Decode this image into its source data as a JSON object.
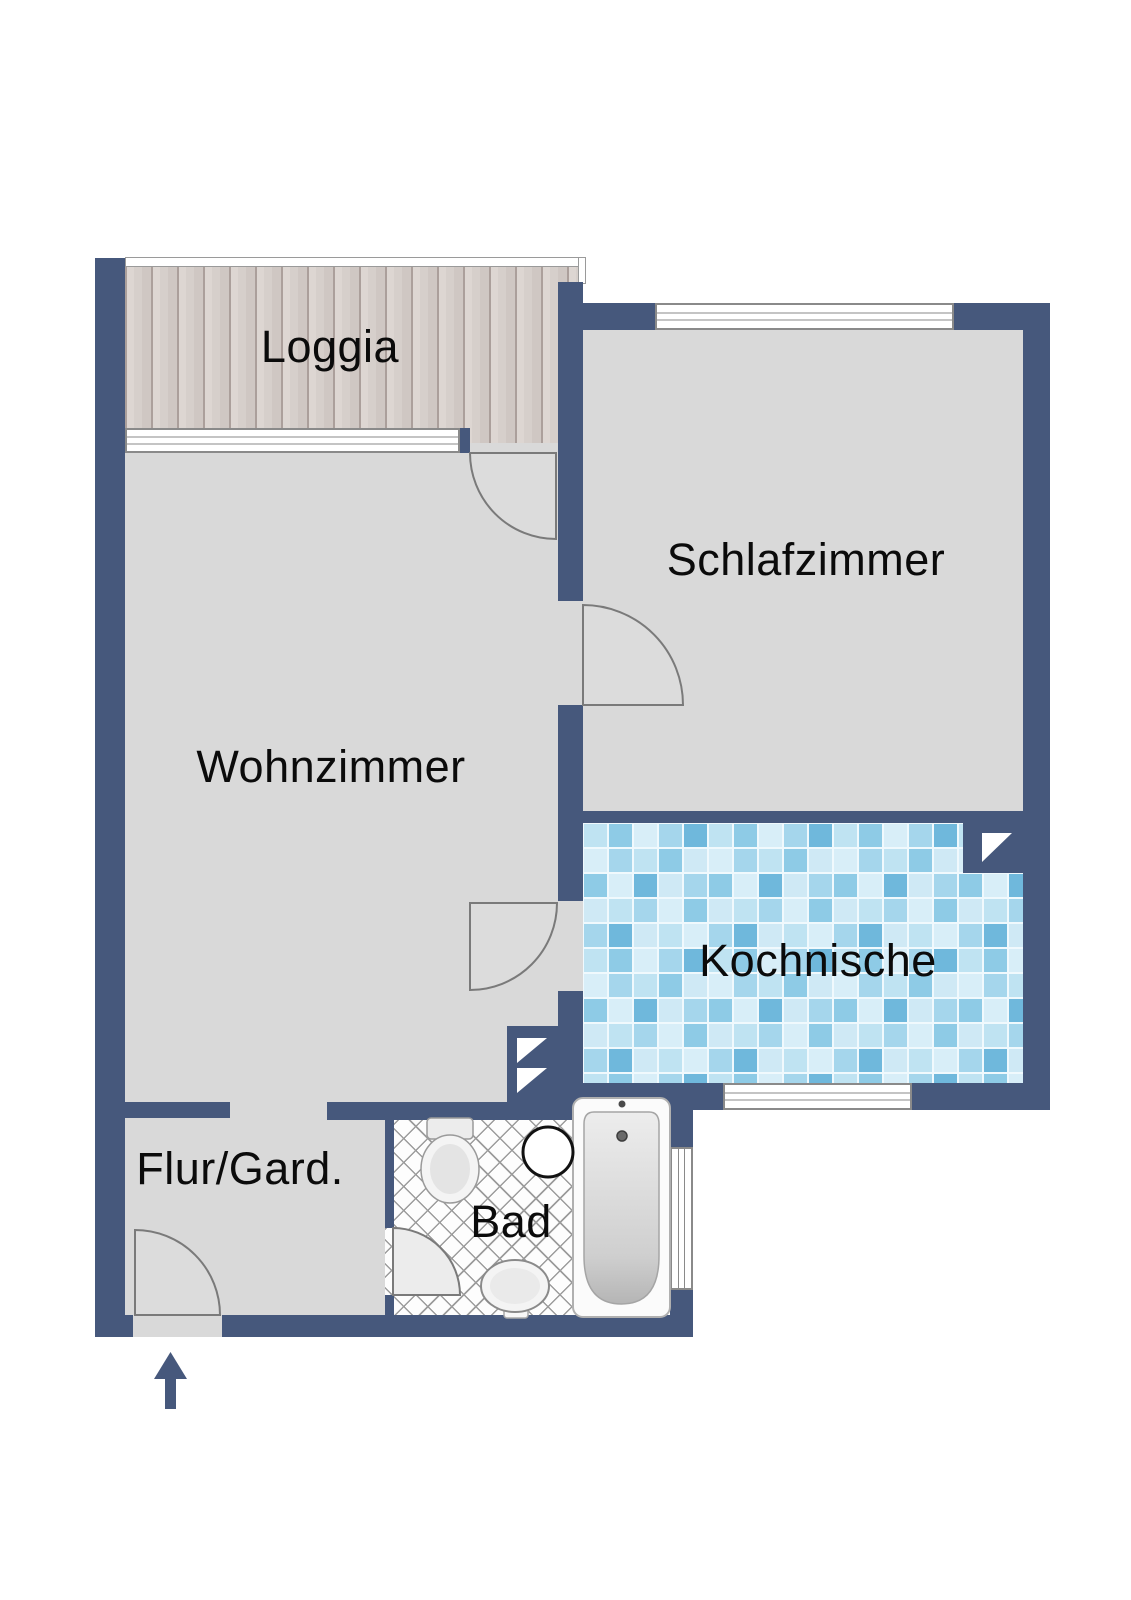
{
  "plan": {
    "type": "apartment-floor-plan",
    "rooms": {
      "loggia": {
        "label": "Loggia"
      },
      "schlafzimmer": {
        "label": "Schlafzimmer"
      },
      "wohnzimmer": {
        "label": "Wohnzimmer"
      },
      "kochnische": {
        "label": "Kochnische"
      },
      "flur": {
        "label": "Flur/Gard."
      },
      "bad": {
        "label": "Bad"
      }
    },
    "fixtures": [
      "bathtub",
      "toilet",
      "washbasin",
      "round-basin"
    ],
    "symbols": [
      "entrance-arrow",
      "door-swing-arcs",
      "shaft-triangles",
      "windows"
    ],
    "colors": {
      "wall": "#46587c",
      "floor": "#d9d9d9",
      "deck_seam": "#ab9f9b",
      "deck_board": "#d8d2ce",
      "tile_joint": "#f0f9fd",
      "tile_light": "#d8eef8",
      "tile_mid": "#a5d6ec",
      "tile_dark": "#6fb8dc",
      "label_color": "#0b0b0b"
    }
  }
}
